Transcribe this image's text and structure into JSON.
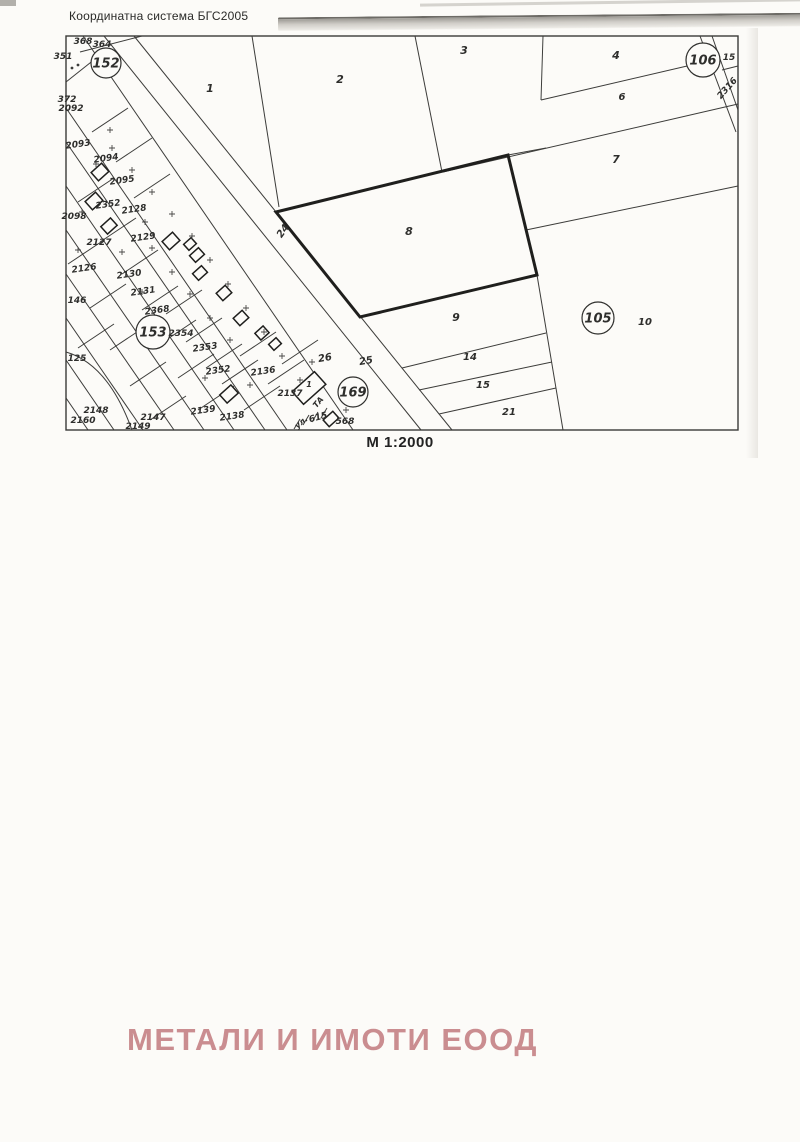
{
  "header": {
    "title": "Координатна система БГС2005"
  },
  "scale": {
    "label": "М 1:2000"
  },
  "watermark": {
    "text": "МЕТАЛИ И ИМОТИ ЕООД",
    "color": "#c27a7e"
  },
  "colors": {
    "ink": "#3c3c3a",
    "bold_ink": "#1f1f1d",
    "label_ink": "#2e2e2c",
    "frame": "#3a3a38",
    "paper": "#fcfbf8"
  },
  "map": {
    "frame": [
      66,
      36,
      738,
      430
    ],
    "bold_parcel_8": [
      276,
      212,
      508,
      155,
      537,
      275,
      360,
      317
    ],
    "lines": [
      [
        104,
        36,
        421,
        430
      ],
      [
        134,
        36,
        452,
        430
      ],
      [
        83,
        36,
        353,
        430
      ],
      [
        80,
        52,
        142,
        36
      ],
      [
        66,
        82,
        100,
        55
      ],
      [
        252,
        36,
        279,
        207
      ],
      [
        415,
        36,
        442,
        172
      ],
      [
        443,
        172,
        738,
        104
      ],
      [
        543,
        36,
        541,
        100
      ],
      [
        541,
        100,
        700,
        63
      ],
      [
        508,
        155,
        546,
        148
      ],
      [
        526,
        230,
        738,
        186
      ],
      [
        537,
        275,
        563,
        430
      ],
      [
        402,
        368,
        546,
        333
      ],
      [
        419,
        390,
        552,
        362
      ],
      [
        439,
        414,
        556,
        388
      ],
      [
        700,
        36,
        736,
        132
      ],
      [
        712,
        36,
        738,
        110
      ],
      [
        722,
        70,
        738,
        66
      ],
      [
        66,
        108,
        287,
        430
      ],
      [
        66,
        142,
        265,
        430
      ],
      [
        66,
        186,
        234,
        430
      ],
      [
        66,
        230,
        204,
        430
      ],
      [
        66,
        274,
        174,
        430
      ],
      [
        66,
        318,
        143,
        430
      ],
      [
        66,
        360,
        114,
        430
      ],
      [
        66,
        398,
        88,
        430
      ],
      [
        92,
        132,
        128,
        108
      ],
      [
        116,
        162,
        152,
        138
      ],
      [
        134,
        198,
        170,
        174
      ],
      [
        78,
        202,
        114,
        178
      ],
      [
        100,
        242,
        136,
        218
      ],
      [
        68,
        264,
        104,
        240
      ],
      [
        122,
        274,
        158,
        250
      ],
      [
        142,
        310,
        178,
        286
      ],
      [
        90,
        308,
        126,
        284
      ],
      [
        160,
        344,
        196,
        320
      ],
      [
        110,
        350,
        146,
        326
      ],
      [
        178,
        378,
        214,
        354
      ],
      [
        130,
        386,
        166,
        362
      ],
      [
        198,
        410,
        234,
        386
      ],
      [
        222,
        384,
        258,
        360
      ],
      [
        240,
        356,
        276,
        332
      ],
      [
        244,
        410,
        280,
        386
      ],
      [
        268,
        384,
        304,
        360
      ],
      [
        282,
        364,
        318,
        340
      ],
      [
        150,
        420,
        186,
        396
      ],
      [
        166,
        314,
        202,
        290
      ],
      [
        186,
        342,
        222,
        318
      ],
      [
        206,
        368,
        242,
        344
      ],
      [
        78,
        348,
        114,
        324
      ]
    ],
    "arcs": [
      "M 66,352 Q 108,364 132,430"
    ],
    "houses": [
      [
        100,
        172,
        14,
        11
      ],
      [
        94,
        201,
        14,
        11
      ],
      [
        109,
        226,
        13,
        10
      ],
      [
        171,
        241,
        14,
        11
      ],
      [
        190,
        244,
        10,
        8
      ],
      [
        197,
        255,
        12,
        9
      ],
      [
        200,
        273,
        12,
        9
      ],
      [
        224,
        293,
        12,
        10
      ],
      [
        241,
        318,
        12,
        10
      ],
      [
        262,
        333,
        11,
        9
      ],
      [
        275,
        344,
        10,
        8
      ],
      [
        229,
        394,
        15,
        11
      ],
      [
        309,
        388,
        30,
        17
      ],
      [
        331,
        419,
        13,
        9
      ]
    ],
    "plus_marks": [
      [
        112,
        148
      ],
      [
        132,
        170
      ],
      [
        152,
        192
      ],
      [
        172,
        214
      ],
      [
        192,
        236
      ],
      [
        210,
        260
      ],
      [
        228,
        284
      ],
      [
        246,
        308
      ],
      [
        264,
        332
      ],
      [
        282,
        356
      ],
      [
        300,
        380
      ],
      [
        152,
        248
      ],
      [
        172,
        272
      ],
      [
        190,
        294
      ],
      [
        210,
        318
      ],
      [
        96,
        164
      ],
      [
        82,
        212
      ],
      [
        122,
        252
      ],
      [
        142,
        292
      ],
      [
        78,
        250
      ],
      [
        346,
        410
      ],
      [
        312,
        362
      ],
      [
        160,
        340
      ],
      [
        230,
        340
      ],
      [
        250,
        385
      ],
      [
        205,
        378
      ],
      [
        110,
        130
      ],
      [
        145,
        222
      ]
    ],
    "slashes": [
      [
        297,
        424
      ],
      [
        306,
        420
      ],
      [
        315,
        417
      ],
      [
        324,
        413
      ]
    ],
    "dots": [
      [
        72,
        68
      ],
      [
        78,
        65
      ]
    ],
    "circles": [
      {
        "label": "152",
        "x": 106,
        "y": 63,
        "r": 15
      },
      {
        "label": "106",
        "x": 703,
        "y": 60,
        "r": 17
      },
      {
        "label": "105",
        "x": 598,
        "y": 318,
        "r": 16
      },
      {
        "label": "153",
        "x": 153,
        "y": 332,
        "r": 17
      },
      {
        "label": "169",
        "x": 353,
        "y": 392,
        "r": 15
      }
    ],
    "labels": [
      {
        "t": "1",
        "x": 210,
        "y": 89,
        "s": 11
      },
      {
        "t": "2",
        "x": 340,
        "y": 80,
        "s": 11
      },
      {
        "t": "3",
        "x": 464,
        "y": 51,
        "s": 11
      },
      {
        "t": "4",
        "x": 616,
        "y": 56,
        "s": 11
      },
      {
        "t": "6",
        "x": 622,
        "y": 97,
        "s": 10
      },
      {
        "t": "7",
        "x": 616,
        "y": 160,
        "s": 11
      },
      {
        "t": "8",
        "x": 409,
        "y": 232,
        "s": 11
      },
      {
        "t": "9",
        "x": 456,
        "y": 318,
        "s": 11
      },
      {
        "t": "10",
        "x": 645,
        "y": 322,
        "s": 10
      },
      {
        "t": "14",
        "x": 470,
        "y": 357,
        "s": 10
      },
      {
        "t": "15",
        "x": 483,
        "y": 385,
        "s": 10
      },
      {
        "t": "21",
        "x": 509,
        "y": 412,
        "s": 10
      },
      {
        "t": "24",
        "x": 283,
        "y": 231,
        "s": 10,
        "r": -55
      },
      {
        "t": "25",
        "x": 366,
        "y": 361,
        "s": 10,
        "r": -10
      },
      {
        "t": "26",
        "x": 325,
        "y": 358,
        "s": 10,
        "r": -10
      },
      {
        "t": "15",
        "x": 729,
        "y": 57,
        "s": 9
      },
      {
        "t": "2316",
        "x": 727,
        "y": 88,
        "s": 9,
        "r": -48
      },
      {
        "t": "368",
        "x": 83,
        "y": 41,
        "s": 9
      },
      {
        "t": "364",
        "x": 102,
        "y": 44,
        "s": 9
      },
      {
        "t": "351",
        "x": 63,
        "y": 56,
        "s": 9
      },
      {
        "t": "372",
        "x": 67,
        "y": 99,
        "s": 9
      },
      {
        "t": "2092",
        "x": 71,
        "y": 108,
        "s": 9
      },
      {
        "t": "2093",
        "x": 78,
        "y": 144,
        "s": 9,
        "r": -8
      },
      {
        "t": "2094",
        "x": 106,
        "y": 158,
        "s": 9,
        "r": -8
      },
      {
        "t": "2095",
        "x": 122,
        "y": 180,
        "s": 9,
        "r": -8
      },
      {
        "t": "2352",
        "x": 108,
        "y": 204,
        "s": 9,
        "r": -8
      },
      {
        "t": "2128",
        "x": 134,
        "y": 209,
        "s": 9,
        "r": -8
      },
      {
        "t": "2098",
        "x": 74,
        "y": 216,
        "s": 9
      },
      {
        "t": "2127",
        "x": 99,
        "y": 242,
        "s": 9
      },
      {
        "t": "2129",
        "x": 143,
        "y": 237,
        "s": 9,
        "r": -8
      },
      {
        "t": "2126",
        "x": 84,
        "y": 268,
        "s": 9,
        "r": -8
      },
      {
        "t": "2130",
        "x": 129,
        "y": 274,
        "s": 9,
        "r": -8
      },
      {
        "t": "2131",
        "x": 143,
        "y": 291,
        "s": 9,
        "r": -8
      },
      {
        "t": "146",
        "x": 77,
        "y": 300,
        "s": 9
      },
      {
        "t": "2368",
        "x": 157,
        "y": 310,
        "s": 9,
        "r": -8
      },
      {
        "t": "2354",
        "x": 181,
        "y": 333,
        "s": 9
      },
      {
        "t": "2353",
        "x": 205,
        "y": 347,
        "s": 9,
        "r": -8
      },
      {
        "t": "125",
        "x": 77,
        "y": 358,
        "s": 9
      },
      {
        "t": "2352",
        "x": 218,
        "y": 370,
        "s": 9,
        "r": -8
      },
      {
        "t": "2136",
        "x": 263,
        "y": 371,
        "s": 9,
        "r": -8
      },
      {
        "t": "2137",
        "x": 290,
        "y": 393,
        "s": 9
      },
      {
        "t": "1",
        "x": 309,
        "y": 384,
        "s": 8
      },
      {
        "t": "2148",
        "x": 96,
        "y": 410,
        "s": 9
      },
      {
        "t": "2160",
        "x": 83,
        "y": 420,
        "s": 9
      },
      {
        "t": "2147",
        "x": 153,
        "y": 417,
        "s": 9
      },
      {
        "t": "2149",
        "x": 138,
        "y": 426,
        "s": 9
      },
      {
        "t": "2139",
        "x": 203,
        "y": 410,
        "s": 9,
        "r": -8
      },
      {
        "t": "2138",
        "x": 232,
        "y": 416,
        "s": 9,
        "r": -8
      },
      {
        "t": "ТА",
        "x": 318,
        "y": 402,
        "s": 8,
        "r": -50
      },
      {
        "t": "ул.",
        "x": 301,
        "y": 422,
        "s": 8,
        "r": -40
      },
      {
        "t": "615",
        "x": 318,
        "y": 417,
        "s": 9,
        "r": -15
      },
      {
        "t": "568",
        "x": 345,
        "y": 421,
        "s": 9
      }
    ]
  }
}
